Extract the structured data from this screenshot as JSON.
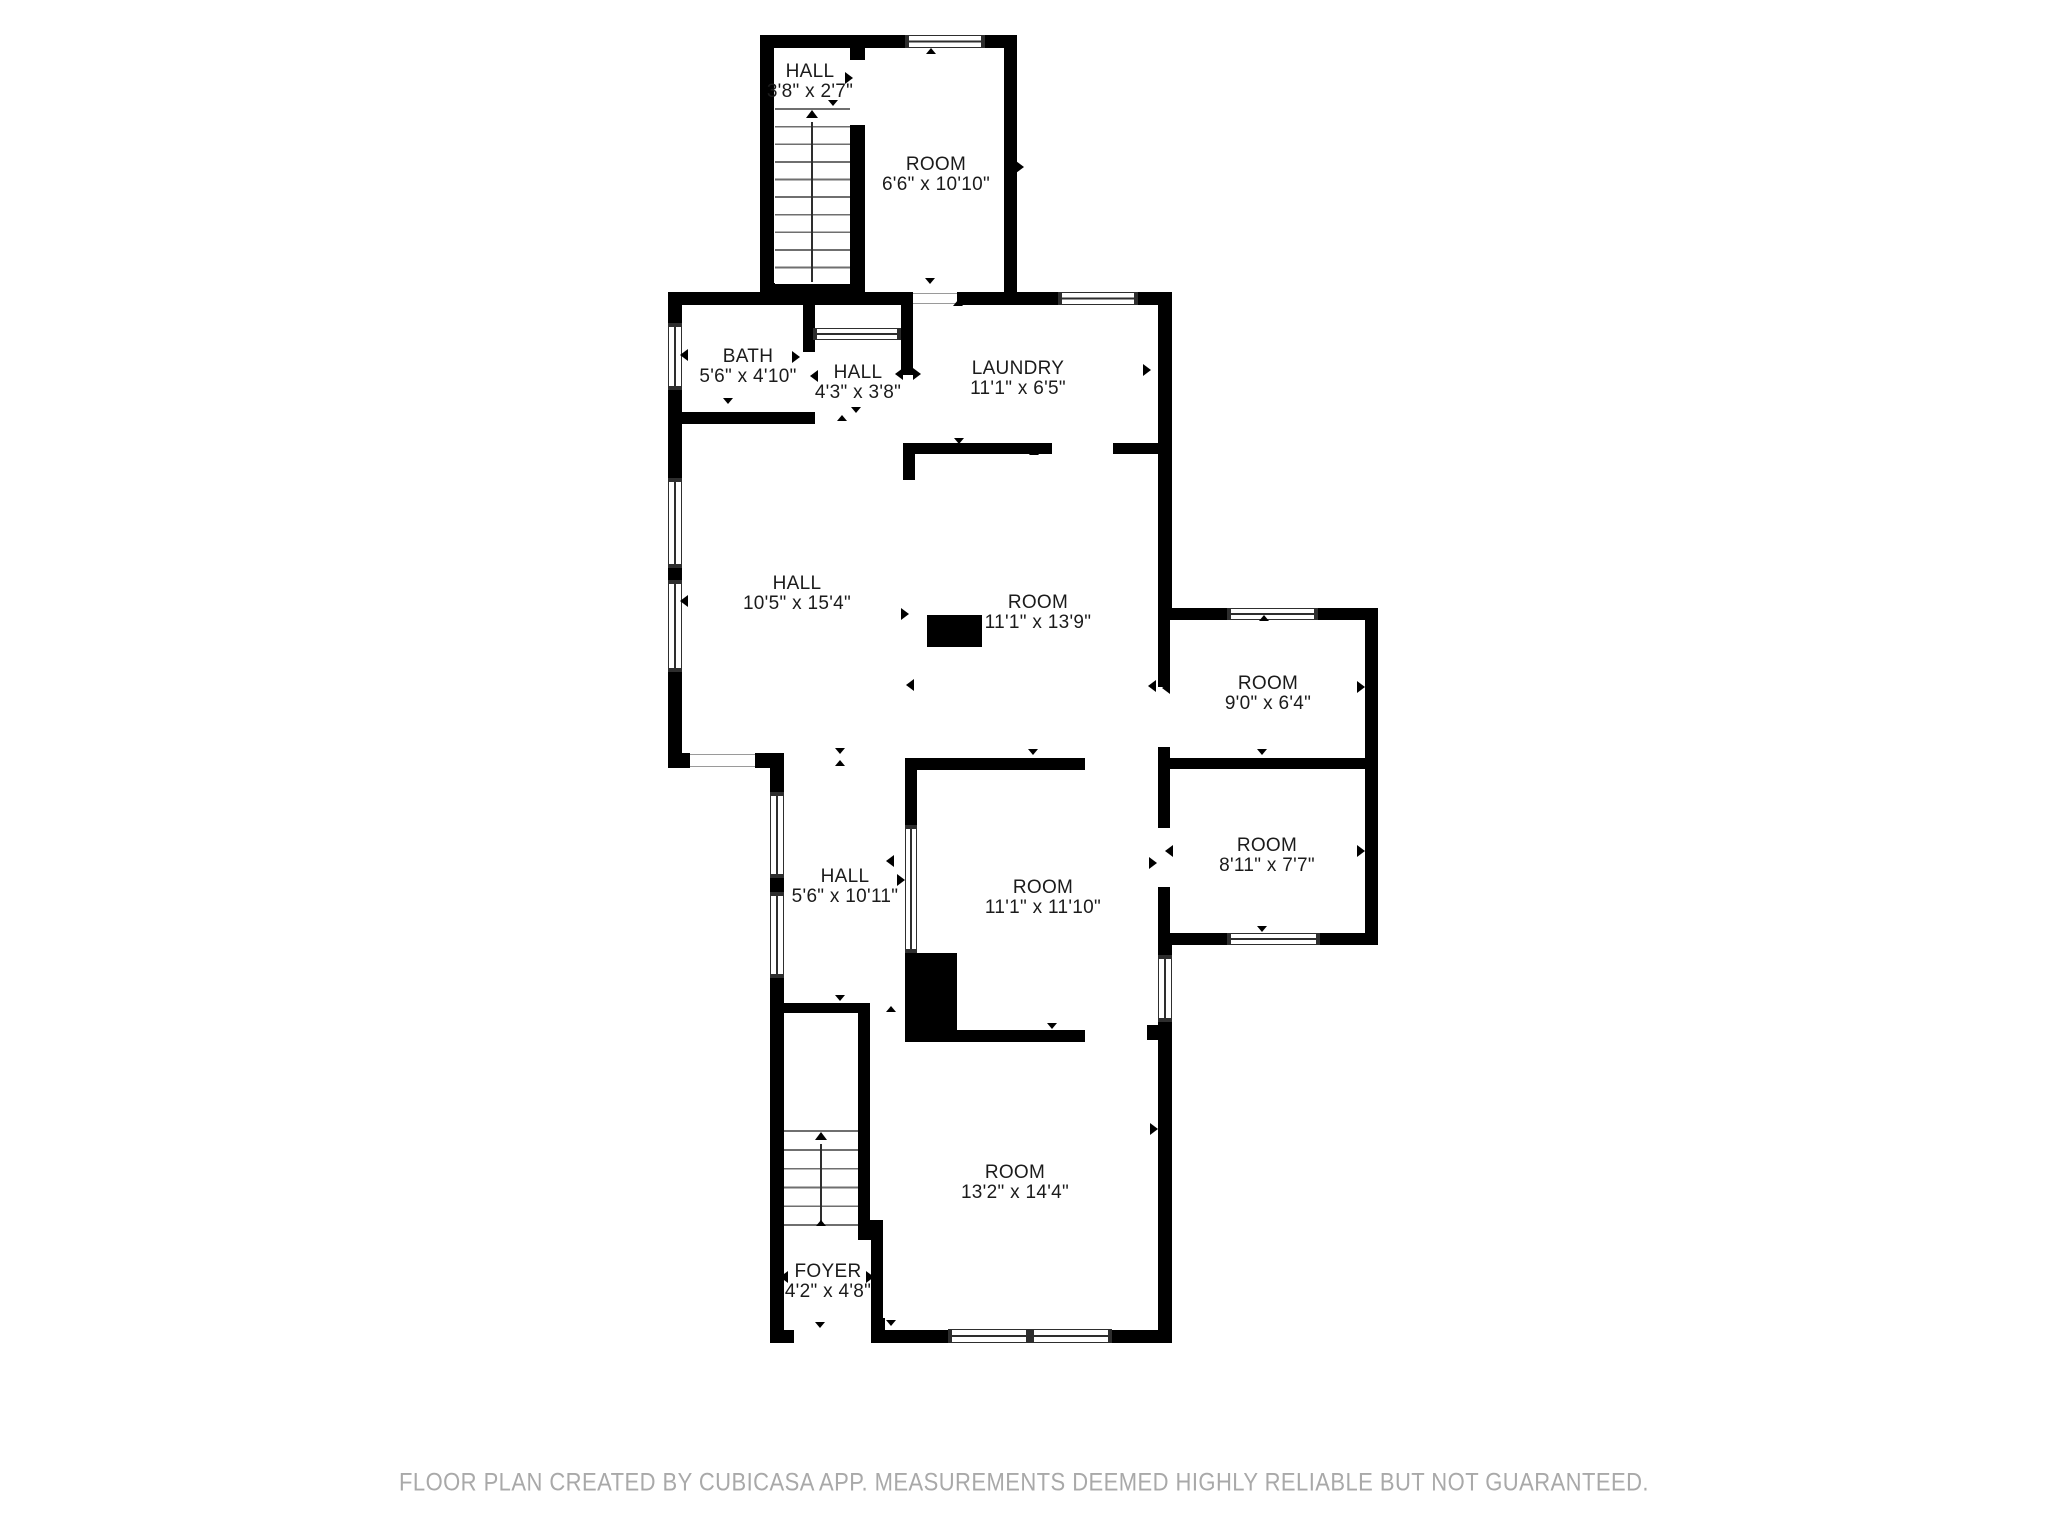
{
  "title": "Floor plan",
  "rooms": [
    {
      "id": "hall-top",
      "name": "HALL",
      "dims": "3'8\" x 2'7\""
    },
    {
      "id": "room-top",
      "name": "ROOM",
      "dims": "6'6\" x 10'10\""
    },
    {
      "id": "bath",
      "name": "BATH",
      "dims": "5'6\" x 4'10\""
    },
    {
      "id": "hall-small",
      "name": "HALL",
      "dims": "4'3\" x 3'8\""
    },
    {
      "id": "laundry",
      "name": "LAUNDRY",
      "dims": "11'1\" x 6'5\""
    },
    {
      "id": "hall-main",
      "name": "HALL",
      "dims": "10'5\" x 15'4\""
    },
    {
      "id": "room-mid",
      "name": "ROOM",
      "dims": "11'1\" x 13'9\""
    },
    {
      "id": "room-ne",
      "name": "ROOM",
      "dims": "9'0\" x 6'4\""
    },
    {
      "id": "room-e",
      "name": "ROOM",
      "dims": "8'11\" x 7'7\""
    },
    {
      "id": "hall-lower",
      "name": "HALL",
      "dims": "5'6\" x 10'11\""
    },
    {
      "id": "room-center",
      "name": "ROOM",
      "dims": "11'1\" x 11'10\""
    },
    {
      "id": "room-south",
      "name": "ROOM",
      "dims": "13'2\" x 14'4\""
    },
    {
      "id": "foyer",
      "name": "FOYER",
      "dims": "4'2\" x 4'8\""
    }
  ],
  "footer": {
    "text": "FLOOR PLAN CREATED BY CUBICASA APP. MEASUREMENTS DEEMED HIGHLY RELIABLE BUT NOT GUARANTEED."
  },
  "colors": {
    "wall": "#000000",
    "window_frame": "#2e2e2e",
    "stair_line": "#6f6f6f",
    "label_text": "#1b1b1b",
    "footer_text": "#a9a9a9",
    "background": "#ffffff"
  }
}
